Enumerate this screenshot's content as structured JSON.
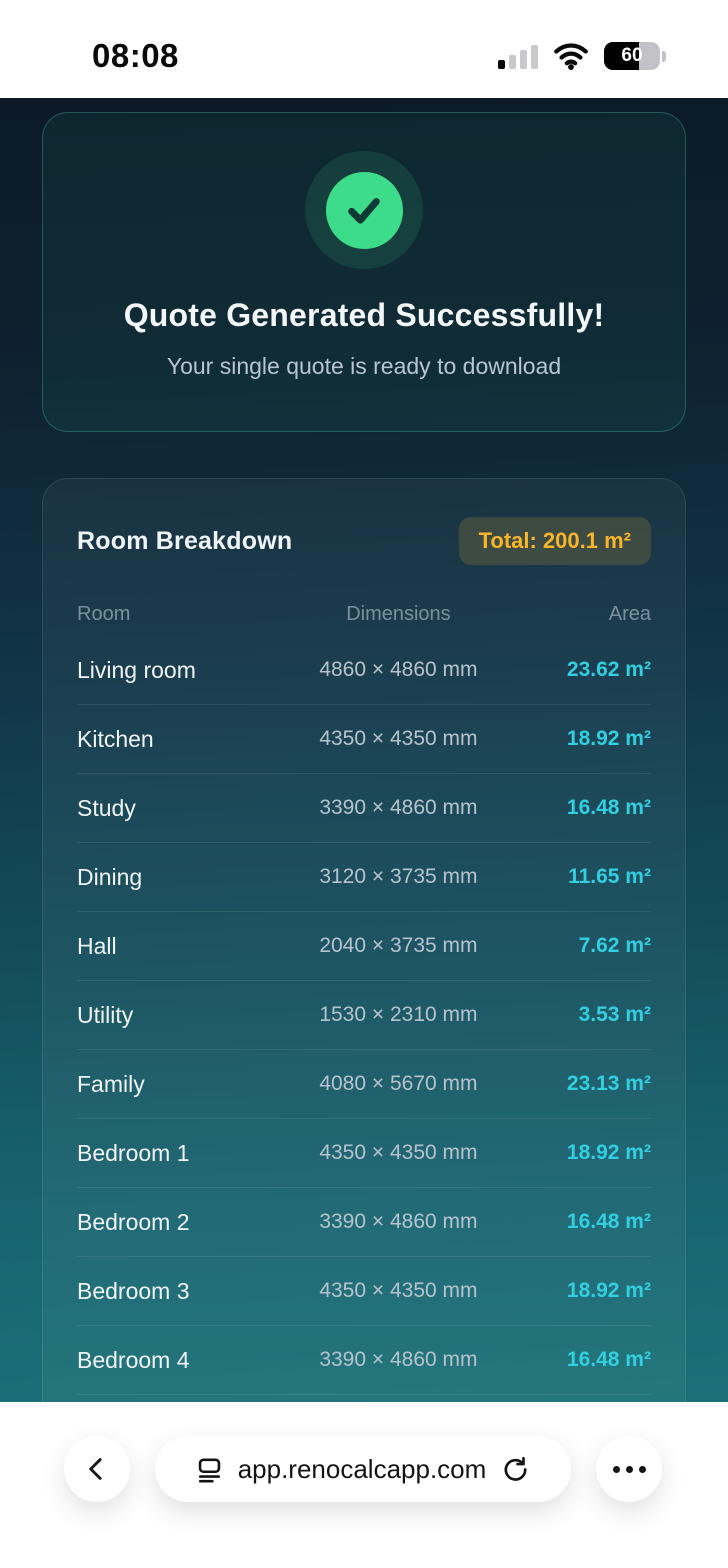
{
  "status_bar": {
    "time": "08:08",
    "battery_percent": "60"
  },
  "success_card": {
    "title": "Quote Generated Successfully!",
    "subtitle": "Your single quote is ready to download"
  },
  "breakdown": {
    "title": "Room Breakdown",
    "total_badge": "Total: 200.1 m²",
    "columns": [
      "Room",
      "Dimensions",
      "Area"
    ],
    "rows": [
      {
        "room": "Living room",
        "dimensions": "4860 × 4860 mm",
        "area": "23.62 m²"
      },
      {
        "room": "Kitchen",
        "dimensions": "4350 × 4350 mm",
        "area": "18.92 m²"
      },
      {
        "room": "Study",
        "dimensions": "3390 × 4860 mm",
        "area": "16.48 m²"
      },
      {
        "room": "Dining",
        "dimensions": "3120 × 3735 mm",
        "area": "11.65 m²"
      },
      {
        "room": "Hall",
        "dimensions": "2040 × 3735 mm",
        "area": "7.62 m²"
      },
      {
        "room": "Utility",
        "dimensions": "1530 × 2310 mm",
        "area": "3.53 m²"
      },
      {
        "room": "Family",
        "dimensions": "4080 × 5670 mm",
        "area": "23.13 m²"
      },
      {
        "room": "Bedroom 1",
        "dimensions": "4350 × 4350 mm",
        "area": "18.92 m²"
      },
      {
        "room": "Bedroom 2",
        "dimensions": "3390 × 4860 mm",
        "area": "16.48 m²"
      },
      {
        "room": "Bedroom 3",
        "dimensions": "4350 × 4350 mm",
        "area": "18.92 m²"
      },
      {
        "room": "Bedroom 4",
        "dimensions": "3390 × 4860 mm",
        "area": "16.48 m²"
      }
    ]
  },
  "browser_bar": {
    "url": "app.renocalcapp.com"
  },
  "colors": {
    "accent_cyan": "#33cfe0",
    "accent_amber": "#f9b42a",
    "success_green": "#3ddc8a",
    "bg_top": "#0c1a27",
    "bg_bottom": "#1b7078"
  }
}
